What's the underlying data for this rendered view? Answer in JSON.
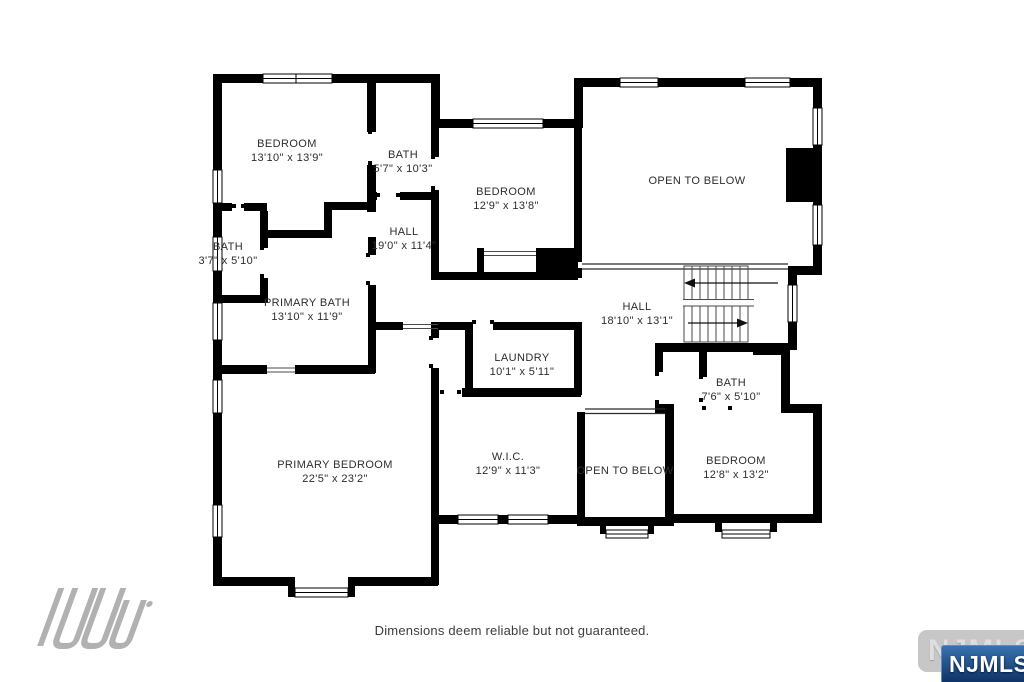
{
  "floorplan": {
    "wall_color": "#000000",
    "label_color": "#2d2d2d",
    "rooms": [
      {
        "id": "bedroom-top-left",
        "name": "BEDROOM",
        "dims": "13'10\" x 13'9\"",
        "x": 287,
        "y": 147
      },
      {
        "id": "bath-top",
        "name": "BATH",
        "dims": "5'7\" x 10'3\"",
        "x": 403,
        "y": 158
      },
      {
        "id": "bedroom-top-middle",
        "name": "BEDROOM",
        "dims": "12'9\" x 13'8\"",
        "x": 506,
        "y": 195
      },
      {
        "id": "open-to-below-top",
        "name": "OPEN TO BELOW",
        "dims": "",
        "x": 697,
        "y": 184
      },
      {
        "id": "bath-left",
        "name": "BATH",
        "dims": "3'7\" x 5'10\"",
        "x": 228,
        "y": 250
      },
      {
        "id": "hall-upper",
        "name": "HALL",
        "dims": "19'0\" x 11'4\"",
        "x": 404,
        "y": 235
      },
      {
        "id": "primary-bath",
        "name": "PRIMARY BATH",
        "dims": "13'10\" x 11'9\"",
        "x": 307,
        "y": 306
      },
      {
        "id": "hall-main",
        "name": "HALL",
        "dims": "18'10\" x 13'1\"",
        "x": 637,
        "y": 310
      },
      {
        "id": "laundry",
        "name": "LAUNDRY",
        "dims": "10'1\" x 5'11\"",
        "x": 522,
        "y": 361
      },
      {
        "id": "bath-right",
        "name": "BATH",
        "dims": "7'6\" x 5'10\"",
        "x": 731,
        "y": 386
      },
      {
        "id": "primary-bedroom",
        "name": "PRIMARY BEDROOM",
        "dims": "22'5\" x 23'2\"",
        "x": 335,
        "y": 468
      },
      {
        "id": "walk-in-closet",
        "name": "W.I.C.",
        "dims": "12'9\" x 11'3\"",
        "x": 508,
        "y": 460
      },
      {
        "id": "open-to-below-bottom",
        "name": "OPEN TO BELOW",
        "dims": "",
        "x": 625,
        "y": 474
      },
      {
        "id": "bedroom-bottom-right",
        "name": "BEDROOM",
        "dims": "12'8\" x 13'2\"",
        "x": 736,
        "y": 464
      }
    ]
  },
  "footer": {
    "disclaimer": "Dimensions deem reliable but not guaranteed."
  },
  "branding": {
    "watermark_label": "NJMLS",
    "badge_label": "NJMLS",
    "badge_color_top": "#3a72b0",
    "badge_color_bottom": "#0e3264",
    "watermark_color": "#c7c7c7",
    "logo_color": "#a9a9a9"
  }
}
